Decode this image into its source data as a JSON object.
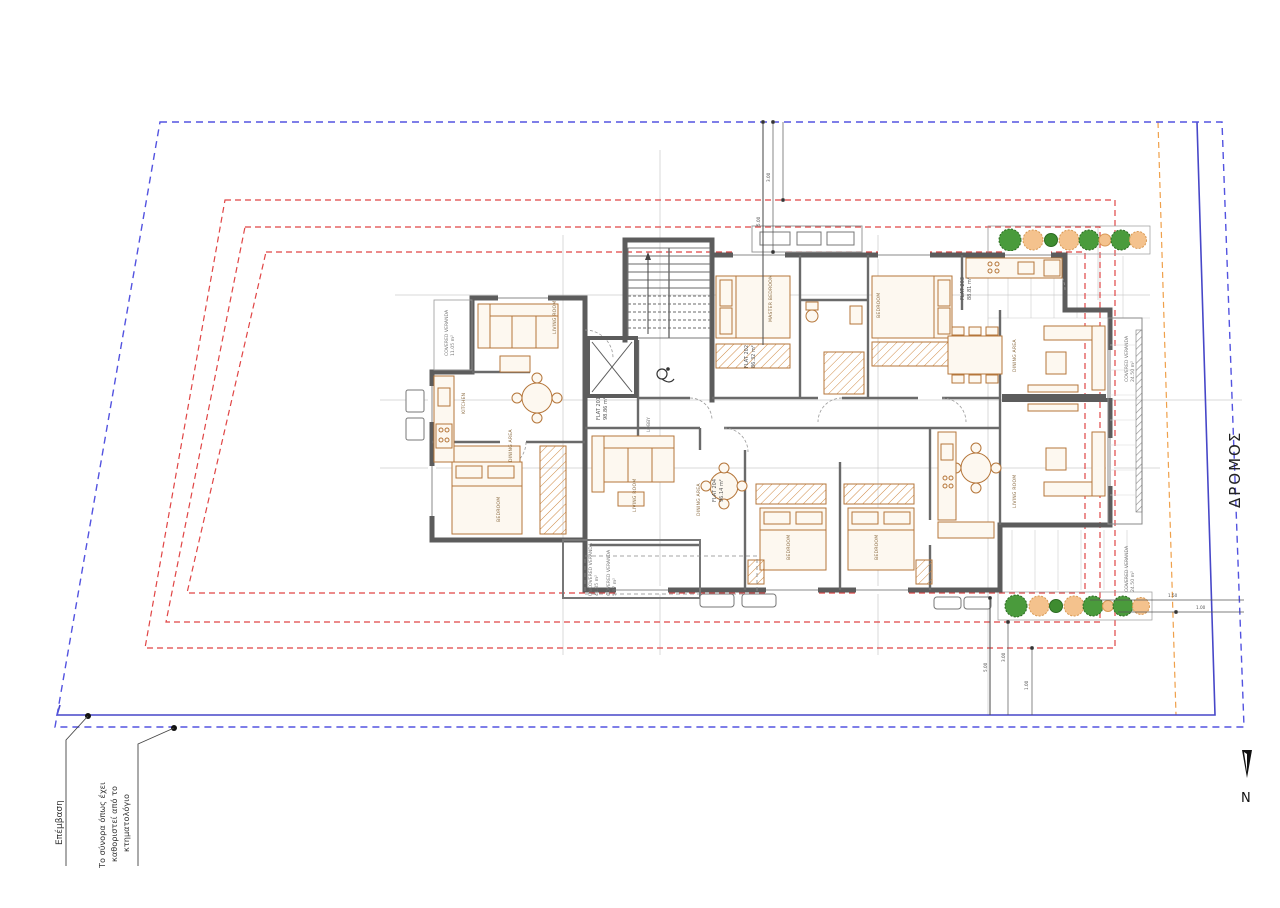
{
  "site": {
    "road_label": "ΔΡΟΜΟΣ",
    "north_label": "N",
    "annotations": {
      "intervention": "Επέμβαση",
      "boundary_note": [
        "Το σύνορα όπως έχει",
        "καθοριστεί από το",
        "κτηματολόγιο"
      ]
    },
    "colors": {
      "boundary_solid": "#4747c8",
      "boundary_dashed": "#5353e0",
      "setback_red": "#e04545",
      "green_zone_orange": "#efa04a",
      "wall_gray": "#5c5c5c",
      "furniture_tan": "#b5763a",
      "tree_green": "#4a9b3c",
      "tree_orange": "#f4c28d"
    }
  },
  "rooms": {
    "living": "LIVING ROOM",
    "kitchen": "KITCHEN",
    "dining": "DINING AREA",
    "bedroom": "BEDROOM",
    "master": "MASTER BEDROOM",
    "lobby": "LOBBY",
    "covered_veranda": "COVERED VERANDA",
    "uncovered_veranda": "UNCOVERED VERANDA"
  },
  "flats": [
    {
      "label": "FLAT 201",
      "area": "98.86 m²"
    },
    {
      "label": "FLAT 202",
      "area": "86.32 m²"
    },
    {
      "label": "FLAT 203",
      "area": "88.81 m²"
    },
    {
      "label": "FLAT 204",
      "area": "96.14 m²"
    }
  ],
  "verandas": {
    "right_top_area": "24.50 m²",
    "right_bottom_area": "24.50 m²",
    "bottom_area": "5.87 m²",
    "uncovered_area": "41.85 m²",
    "balcony_area": "11.05 m²"
  },
  "dims": {
    "d300": "3.00",
    "d500": "5.00",
    "d100": "1.00",
    "d150": "1.50"
  }
}
